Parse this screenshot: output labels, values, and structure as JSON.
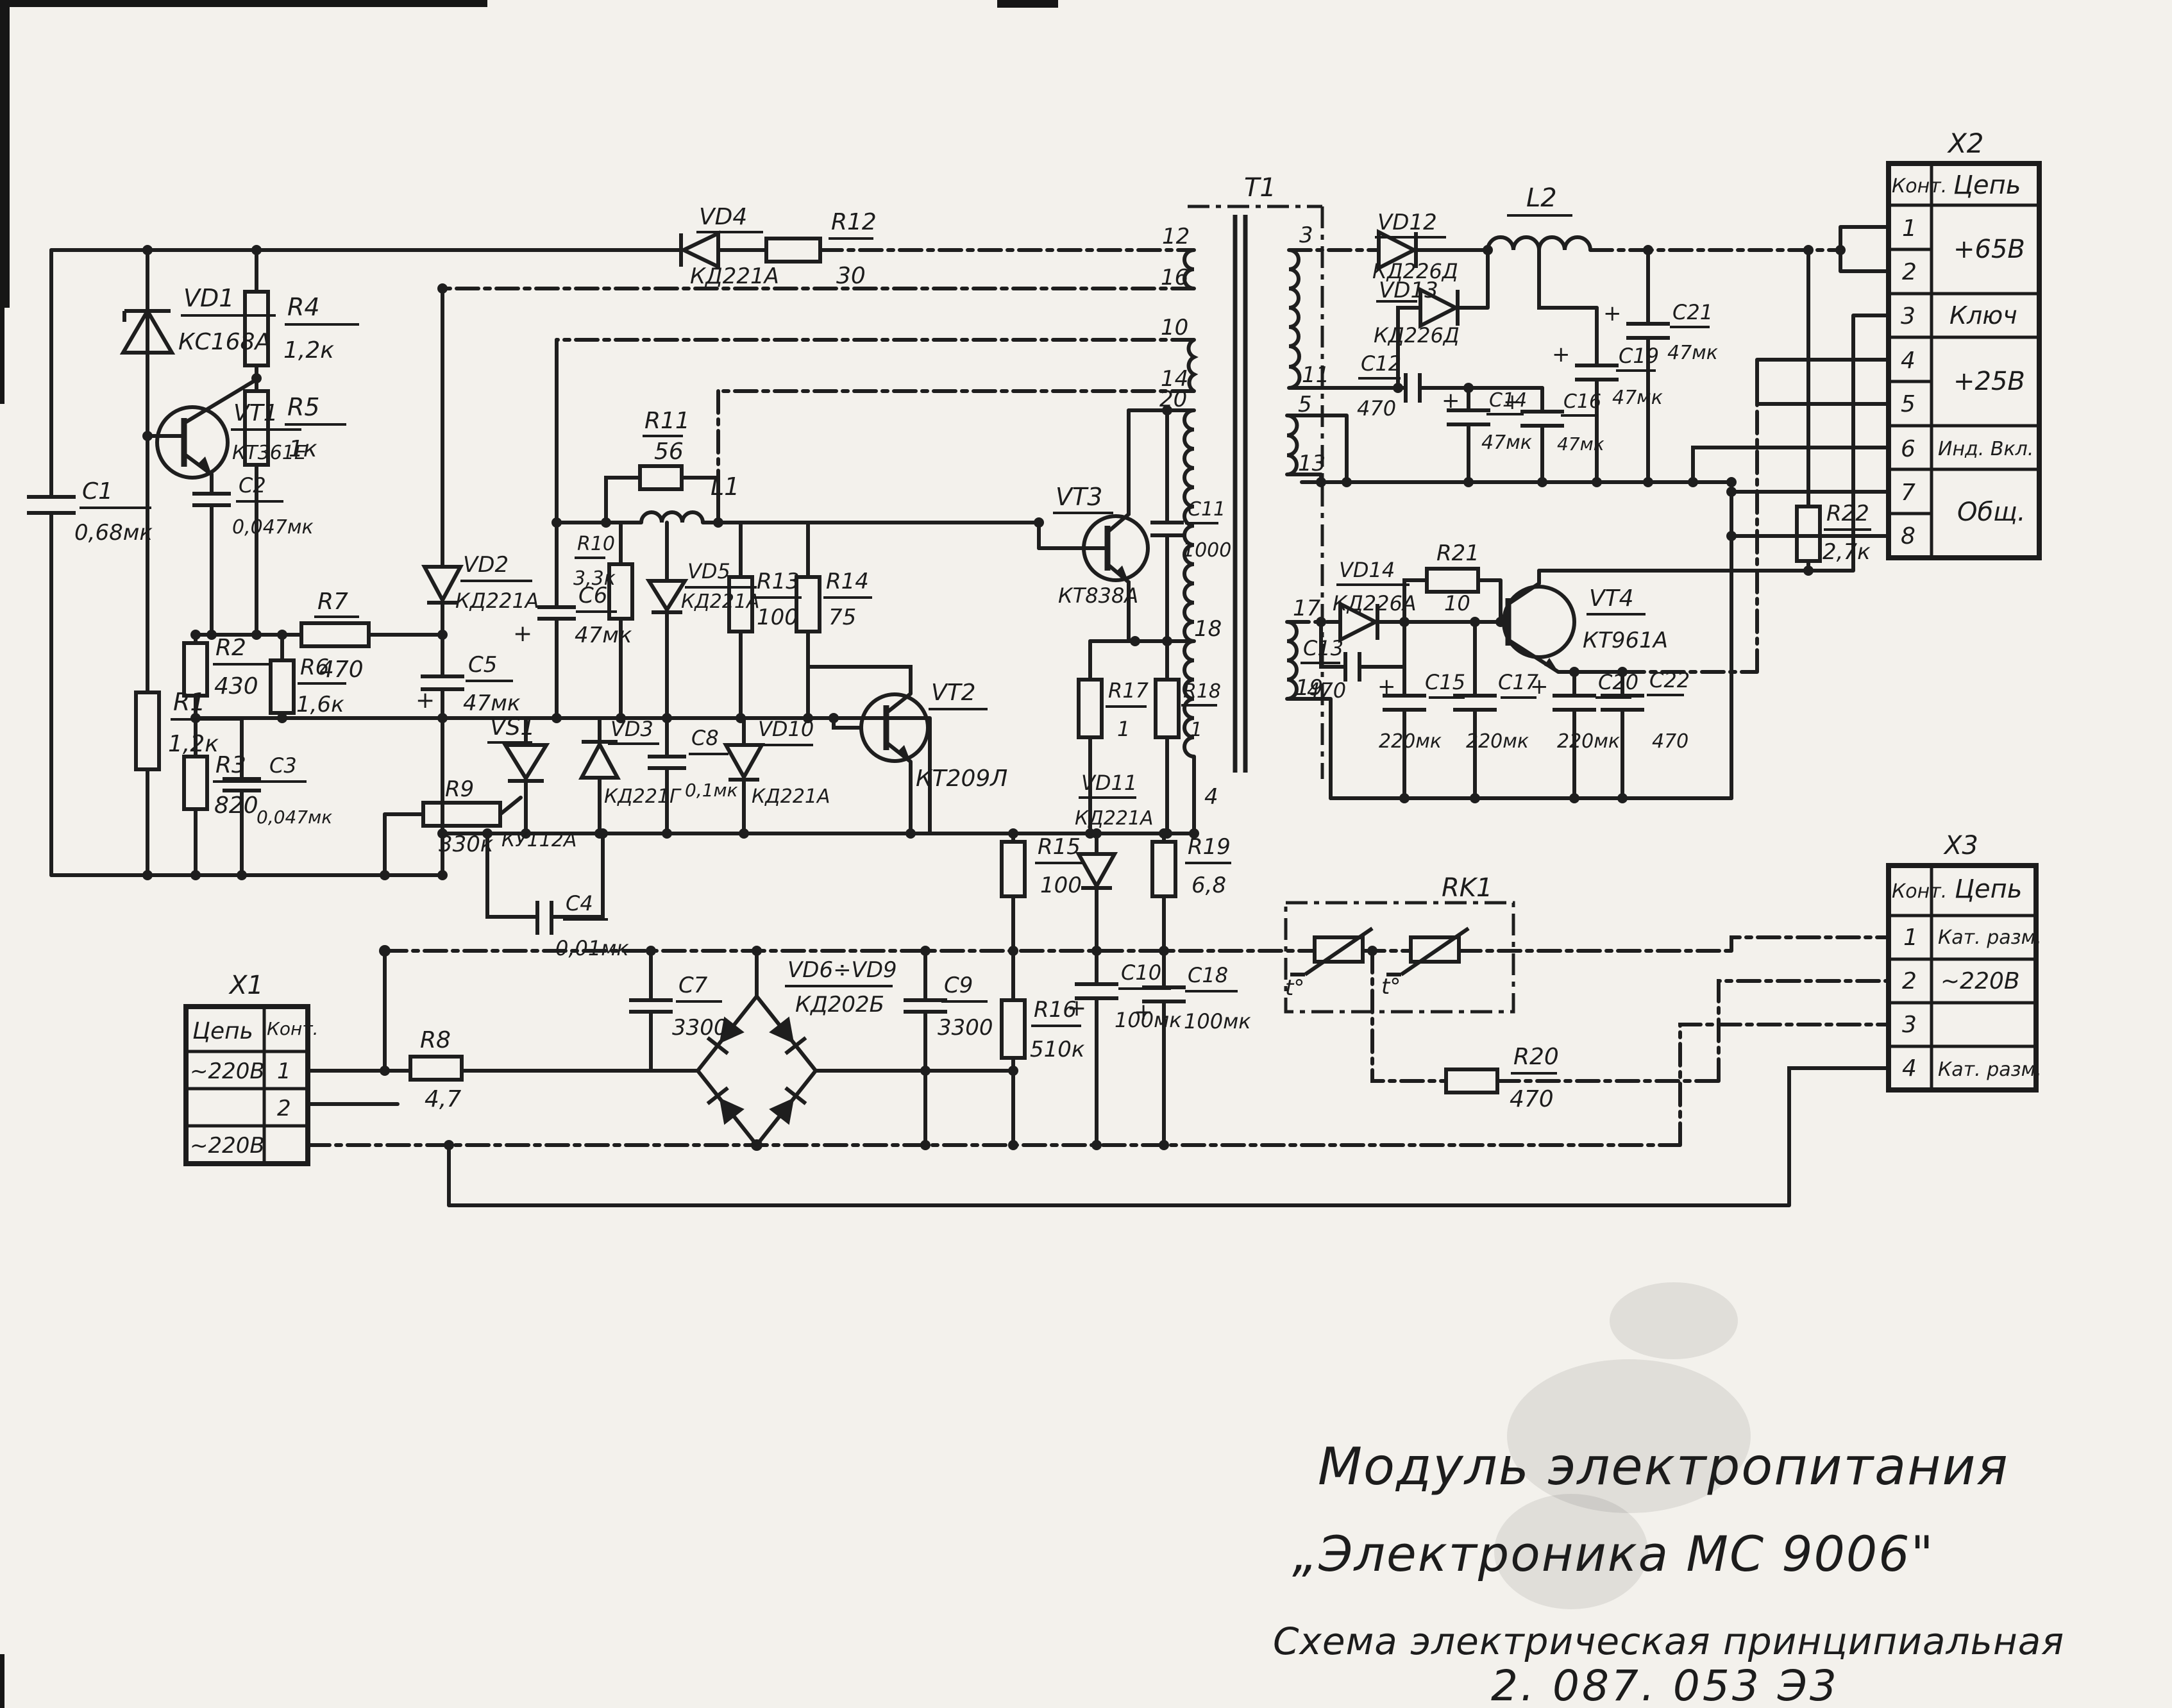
{
  "title_block": {
    "line1": "Модуль электропитания",
    "line2": "„Электроника  МС 9006\"",
    "line3": "Схема электрическая принципиальная",
    "line4": "2. 087. 053 Э3"
  },
  "symbols": {
    "plus": "+",
    "temp": "t°"
  },
  "components": {
    "c1": {
      "d": "C1",
      "v": "0,68мк"
    },
    "vd1": {
      "d": "VD1",
      "v": "КС168А"
    },
    "r4": {
      "d": "R4",
      "v": "1,2к"
    },
    "r5": {
      "d": "R5",
      "v": "1к"
    },
    "vt1": {
      "d": "VT1",
      "v": "КТ361Е"
    },
    "c2": {
      "d": "C2",
      "v": "0,047мк"
    },
    "r1": {
      "d": "R1",
      "v": "1,2к"
    },
    "r2": {
      "d": "R2",
      "v": "430"
    },
    "r3": {
      "d": "R3",
      "v": "820"
    },
    "c3": {
      "d": "C3",
      "v": "0,047мк"
    },
    "r6": {
      "d": "R6",
      "v": "1,6к"
    },
    "r7": {
      "d": "R7",
      "v": "470"
    },
    "vd2": {
      "d": "VD2",
      "v": "КД221А"
    },
    "c5": {
      "d": "C5",
      "v": "47мк"
    },
    "c6": {
      "d": "C6",
      "v": "47мк"
    },
    "r10": {
      "d": "R10",
      "v": "3,3к"
    },
    "r11": {
      "d": "R11",
      "v": "56"
    },
    "l1": {
      "d": "L1"
    },
    "vd5": {
      "d": "VD5",
      "v": "КД221А"
    },
    "r13": {
      "d": "R13",
      "v": "100"
    },
    "r14": {
      "d": "R14",
      "v": "75"
    },
    "vd4": {
      "d": "VD4",
      "v": "КД221А"
    },
    "r12": {
      "d": "R12",
      "v": "30"
    },
    "vs1": {
      "d": "VS1",
      "v": "КУ112А"
    },
    "vd3": {
      "d": "VD3",
      "v": "КД221Г"
    },
    "c8": {
      "d": "C8",
      "v": "0,1мк"
    },
    "vd10": {
      "d": "VD10",
      "v": "КД221А"
    },
    "vt2": {
      "d": "VT2",
      "v": "КТ209Л"
    },
    "r9": {
      "d": "R9",
      "v": "330к"
    },
    "c4": {
      "d": "C4",
      "v": "0,01мк"
    },
    "vt3": {
      "d": "VT3",
      "v": "КТ838А"
    },
    "c11": {
      "d": "C11",
      "v": "1000"
    },
    "r17": {
      "d": "R17",
      "v": "1"
    },
    "r18": {
      "d": "R18",
      "v": "1"
    },
    "vd12": {
      "d": "VD12",
      "v": "КД226Д"
    },
    "vd13": {
      "d": "VD13",
      "v": "КД226Д"
    },
    "l2": {
      "d": "L2"
    },
    "c12": {
      "d": "C12",
      "v": "470"
    },
    "c14": {
      "d": "C14",
      "v": "47мк"
    },
    "c16": {
      "d": "C16",
      "v": "47мк"
    },
    "c19": {
      "d": "C19",
      "v": "47мк"
    },
    "c21": {
      "d": "C21",
      "v": "47мк"
    },
    "r22": {
      "d": "R22",
      "v": "2,7к"
    },
    "vd14": {
      "d": "VD14",
      "v": "КД226А"
    },
    "c13": {
      "d": "C13",
      "v": "470"
    },
    "r21": {
      "d": "R21",
      "v": "10"
    },
    "c15": {
      "d": "C15",
      "v": "220мк"
    },
    "c17": {
      "d": "C17",
      "v": "220мк"
    },
    "vt4": {
      "d": "VT4",
      "v": "КТ961А"
    },
    "c20": {
      "d": "C20",
      "v": "220мк"
    },
    "c22": {
      "d": "C22",
      "v": "470"
    },
    "r15": {
      "d": "R15",
      "v": "100"
    },
    "vd11": {
      "d": "VD11",
      "v": "КД221А"
    },
    "r19": {
      "d": "R19",
      "v": "6,8"
    },
    "c10": {
      "d": "C10",
      "v": "100мк"
    },
    "c18": {
      "d": "C18",
      "v": "100мк"
    },
    "r16": {
      "d": "R16",
      "v": "510к"
    },
    "c7": {
      "d": "C7",
      "v": "3300"
    },
    "vd69": {
      "d": "VD6÷VD9",
      "v": "КД202Б"
    },
    "c9": {
      "d": "C9",
      "v": "3300"
    },
    "r8": {
      "d": "R8",
      "v": "4,7"
    },
    "r20": {
      "d": "R20",
      "v": "470"
    },
    "rk1": {
      "d": "RK1"
    }
  },
  "transformer": {
    "label": "Т1",
    "p12": "12",
    "p16": "16",
    "p10": "10",
    "p14": "14",
    "p20": "20",
    "p18": "18",
    "p4": "4",
    "p3": "3",
    "p11": "11",
    "p5": "5",
    "p13": "13",
    "p17": "17",
    "p19": "19"
  },
  "x1": {
    "title": "X1",
    "hdr_c": "Цепь",
    "hdr_p": "Конт.",
    "rows": [
      {
        "c": "~220В",
        "p": "1"
      },
      {
        "c": "",
        "p": "2"
      },
      {
        "c": "~220В",
        "p": ""
      }
    ]
  },
  "x2": {
    "title": "X2",
    "hdr_p": "Конт.",
    "hdr_c": "Цепь",
    "pins": [
      "1",
      "2",
      "3",
      "4",
      "5",
      "6",
      "7",
      "8"
    ],
    "circuits": {
      "v65": "+65В",
      "key": "Ключ",
      "v25": "+25В",
      "ind": "Инд. Вкл.",
      "com": "Общ."
    }
  },
  "x3": {
    "title": "X3",
    "hdr_p": "Конт.",
    "hdr_c": "Цепь",
    "rows": [
      {
        "p": "1",
        "c": "Кат. разм."
      },
      {
        "p": "2",
        "c": "~220В"
      },
      {
        "p": "3",
        "c": ""
      },
      {
        "p": "4",
        "c": "Кат. разм."
      }
    ]
  }
}
